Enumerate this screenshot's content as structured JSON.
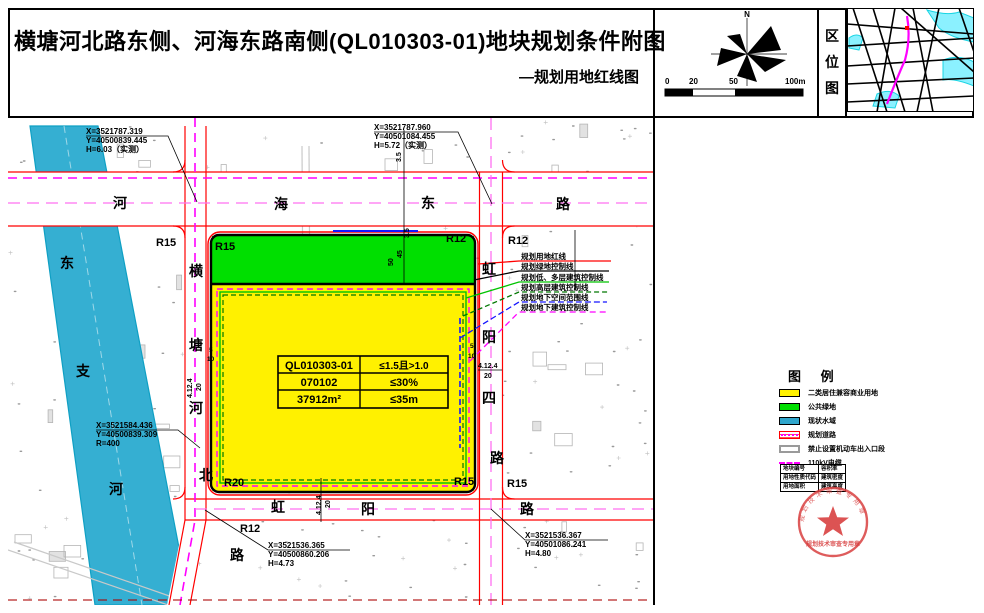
{
  "title": {
    "main": "横塘河北路东侧、河海东路南侧(QL010303-01)地块规划条件附图",
    "sub": "—规划用地红线图"
  },
  "header": {
    "north_label": "N",
    "scale_ticks": [
      "0",
      "20",
      "50",
      "100m"
    ],
    "location_label": [
      "区",
      "位",
      "图"
    ]
  },
  "coords": {
    "c1": {
      "l1": "X=3521787.319",
      "l2": "Y=40500839.445",
      "l3": "H=6.03（实测）"
    },
    "c2": {
      "l1": "X=3521787.960",
      "l2": "Y=40501084.455",
      "l3": "H=5.72（实测）"
    },
    "c3": {
      "l1": "X=3521584.436",
      "l2": "Y=40500839.309",
      "l3": "R=400"
    },
    "c4": {
      "l1": "X=3521536.365",
      "l2": "Y=40500860.206",
      "l3": "H=4.73"
    },
    "c5": {
      "l1": "X=3521536.367",
      "l2": "Y=40501086.241",
      "l3": "H=4.80"
    }
  },
  "roads": {
    "north": {
      "name": "河海东路",
      "chars": [
        "河",
        "海",
        "东",
        "路"
      ]
    },
    "west": {
      "name": "横塘河北路",
      "chars": [
        "横",
        "塘",
        "河",
        "北",
        "路"
      ]
    },
    "east": {
      "name": "虹阳四路",
      "chars": [
        "虹",
        "阳",
        "四",
        "路"
      ]
    },
    "south": {
      "name": "虹阳路",
      "chars": [
        "虹",
        "阳",
        "路"
      ]
    },
    "river": {
      "name": "东支河",
      "chars": [
        "东",
        "支",
        "河"
      ]
    }
  },
  "zone_labels": [
    {
      "text": "R15"
    },
    {
      "text": "R15"
    },
    {
      "text": "R12"
    },
    {
      "text": "R12"
    },
    {
      "text": "R20"
    },
    {
      "text": "R15"
    },
    {
      "text": "R15"
    },
    {
      "text": "R12"
    }
  ],
  "parcel_table": {
    "rows": [
      [
        "QL010303-01",
        "≤1.5且>1.0"
      ],
      [
        "070102",
        "≤30%"
      ],
      [
        "37912m²",
        "≤35m"
      ]
    ]
  },
  "dims": {
    "d35a": "3.5",
    "d35b": "3.5",
    "d45": "45",
    "d50": "50",
    "d4124": "4.12.4",
    "d20": "20",
    "d5": "5",
    "d10": "10"
  },
  "line_callouts": [
    {
      "label": "规划用地红线",
      "color": "#ff0000"
    },
    {
      "label": "规划绿地控制线",
      "color": "#000000"
    },
    {
      "label": "规划低、多层建筑控制线",
      "color": "#00c400"
    },
    {
      "label": "规划高层建筑控制线",
      "color": "#007700"
    },
    {
      "label": "规划地下空间范围线",
      "color": "#1515ff"
    },
    {
      "label": "规划地下建筑控制线",
      "color": "#ff00ff"
    }
  ],
  "legend": {
    "title": "图 例",
    "items": [
      {
        "label": "二类居住兼容商业用地",
        "swatch": "yellow"
      },
      {
        "label": "公共绿地",
        "swatch": "green"
      },
      {
        "label": "现状水域",
        "swatch": "water"
      },
      {
        "label": "规划道路",
        "swatch": "road"
      },
      {
        "label": "禁止设置机动车出入口段",
        "swatch": "noentry"
      },
      {
        "label": "110kV电缆",
        "swatch": "cable"
      }
    ]
  },
  "key_table": {
    "rows": [
      [
        "地块编号",
        "容积率"
      ],
      [
        "用地性质代码",
        "建筑密度"
      ],
      [
        "用地面积",
        "建筑高度"
      ]
    ]
  },
  "stamp": {
    "text": "规划技术审查专用章"
  },
  "colors": {
    "parcel_yellow": "#fff100",
    "public_green": "#00df00",
    "water": "#35afd2",
    "red_line": "#ff0000",
    "magenta": "#ff00ff",
    "center_pink": "#ff70f0"
  }
}
